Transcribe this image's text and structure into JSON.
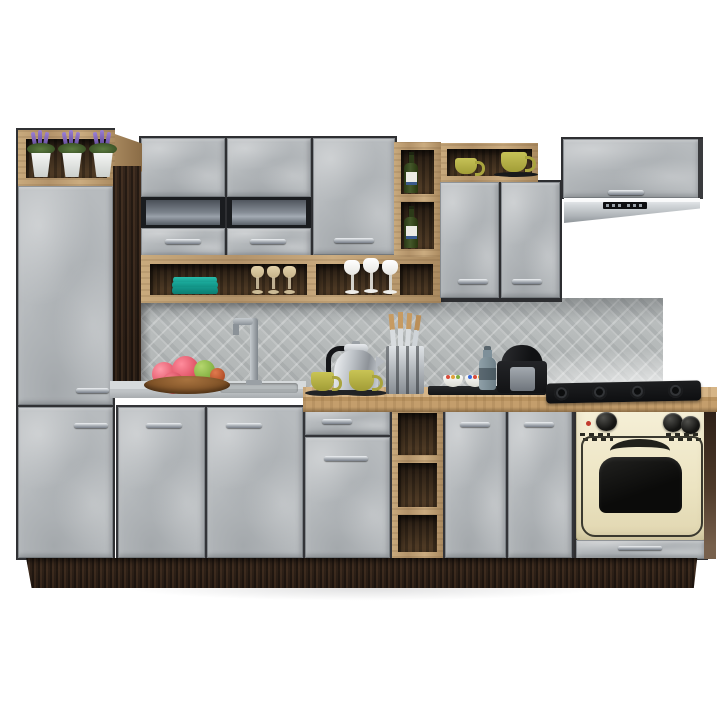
{
  "meta": {
    "description": "Product photo render of a modular kitchen furniture set on a white background",
    "background_color": "#ffffff"
  },
  "palette": {
    "concrete_front": "#b7bbbe",
    "concrete_light": "#d3d6d8",
    "oak": "#bf9f73",
    "oak_edge": "#8f714a",
    "wenge": "#35271d",
    "shelf_interior": "#3c2c1e",
    "glass_insert": "#6b727b",
    "stainless_steel": "#c6cbcf",
    "appliance_black": "#141517",
    "oven_cream": "#f0e9cd",
    "plate_teal": "#18a295",
    "cup_olive": "#b9b34a",
    "lavender": "#7b5fb0",
    "apple_pink": "#e25668",
    "apple_green": "#7fae3f",
    "bottle_green": "#34451d",
    "counter_gray": "#c6cacc"
  },
  "objects": {
    "plant_shelf": {
      "label": "Open top shelf with potted lavender",
      "pot_count": 3
    },
    "tall_cabinet": {
      "label": "Tall pantry cabinet with two concrete-gray doors"
    },
    "filler_panel": {
      "label": "Dark wenge filler panel"
    },
    "wall_cabinet_left": {
      "label": "Wall cabinet with smoked glass insert"
    },
    "wall_cabinet_center": {
      "label": "Wall cabinet with smoked glass insert"
    },
    "wall_cabinet_tall_door": {
      "label": "Wall cabinet with full-height door"
    },
    "glasses_shelf": {
      "label": "Open oak shelf with teal plates and stemware",
      "teal_plates": 3,
      "beige_glasses": 3,
      "white_glasses": 3
    },
    "wine_rack": {
      "label": "Open oak wine rack",
      "bottle_count": 2
    },
    "cup_niche": {
      "label": "Open oak niche with olive cups",
      "cup_count": 2
    },
    "wall_cabinet_double": {
      "label": "Double-door wall cabinet"
    },
    "hood_cabinet": {
      "label": "Flip-up cabinet above cooker hood"
    },
    "cooker_hood": {
      "label": "Built-under stainless cooker hood"
    },
    "backsplash": {
      "label": "Gray mosaic tile backsplash"
    },
    "counter_left": {
      "label": "Light gray worktop with sink"
    },
    "counter_right": {
      "label": "Oak worktop"
    },
    "faucet": {
      "label": "Kitchen faucet"
    },
    "fruit_bowl": {
      "label": "Wooden bowl with apples"
    },
    "kettle": {
      "label": "Stainless kettle"
    },
    "tea_cups": {
      "label": "Olive cups on dark saucers",
      "count": 2
    },
    "knife_block": {
      "label": "Knife block with knives"
    },
    "serving_tray": {
      "label": "Black tray with candy bowls",
      "bowl_count": 2
    },
    "bottle": {
      "label": "Gray bottle"
    },
    "coffee_machine": {
      "label": "Black capsule coffee machine"
    },
    "gas_hob": {
      "label": "Black gas hob",
      "burner_count": 4
    },
    "base_cabinets": {
      "label": "Base cabinets with concrete-gray fronts",
      "door_count": 6,
      "drawer_count": 1
    },
    "base_open_shelf": {
      "label": "Open oak base shelf unit",
      "cell_count": 3
    },
    "oven": {
      "label": "Cream retro built-in oven",
      "knob_count": 3
    },
    "oven_drawer": {
      "label": "Drawer under oven"
    },
    "plinth": {
      "label": "Dark wenge plinth"
    },
    "side_panel": {
      "label": "Dark side panel"
    }
  }
}
